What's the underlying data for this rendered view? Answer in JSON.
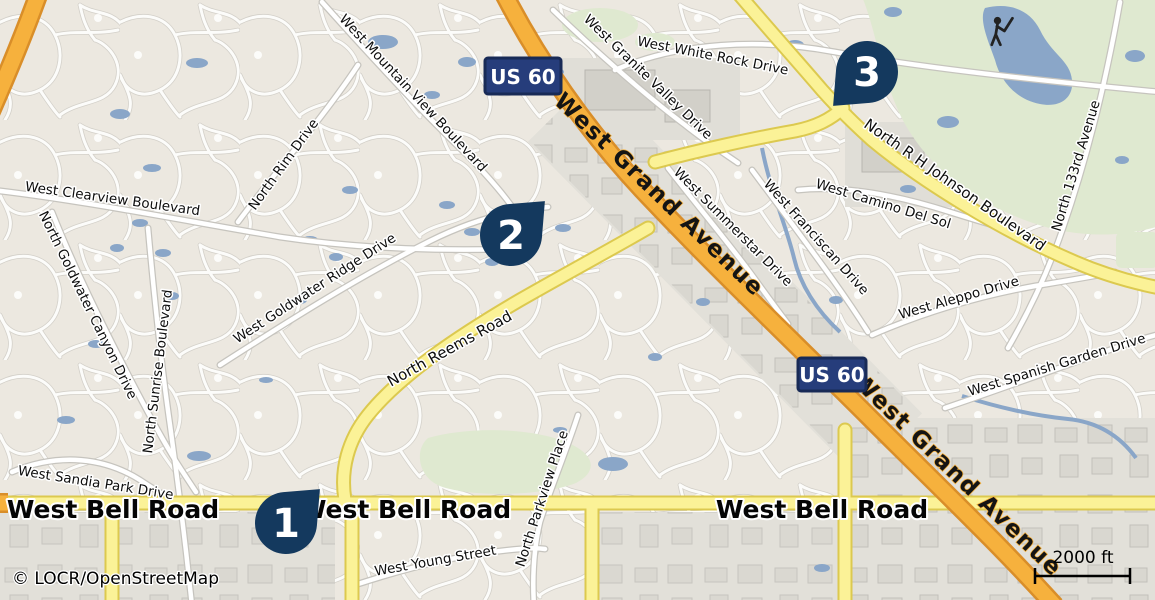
{
  "attribution": "© LOCR/OpenStreetMap",
  "scale": {
    "label": "2000 ft"
  },
  "shields": {
    "us60": "US 60"
  },
  "markers": [
    {
      "number": "1"
    },
    {
      "number": "2"
    },
    {
      "number": "3"
    }
  ],
  "major_roads": {
    "grand_avenue": "West Grand Avenue",
    "bell_road": "West Bell Road"
  },
  "streets": [
    "West Mountain View Boulevard",
    "West Granite Valley Drive",
    "West White Rock Drive",
    "North R H Johnson Boulevard",
    "West Clearview Boulevard",
    "North Rim Drive",
    "North Goldwater Canyon Drive",
    "North Sunrise Boulevard",
    "West Goldwater Ridge Drive",
    "North Reems Road",
    "West Summerstar Drive",
    "West Franciscan Drive",
    "West Camino Del Sol",
    "West Aleppo Drive",
    "West Spanish Garden Drive",
    "North 133rd Avenue",
    "West Sandia Park Drive",
    "North Parkview Place",
    "West Young Street"
  ],
  "icons": {
    "golfer_icon": "golfer-swing-silhouette"
  },
  "colors": {
    "background": "#ECE8E0",
    "marker": "#14395E",
    "highway_orange": "#F6B13D",
    "highway_casing": "#D98E29",
    "road_yellow": "#FBF297",
    "road_yellow_casing": "#DCC94F",
    "water": "#8AA6C8",
    "green": "#DFE9D0",
    "shield_blue": "#263D7B"
  }
}
